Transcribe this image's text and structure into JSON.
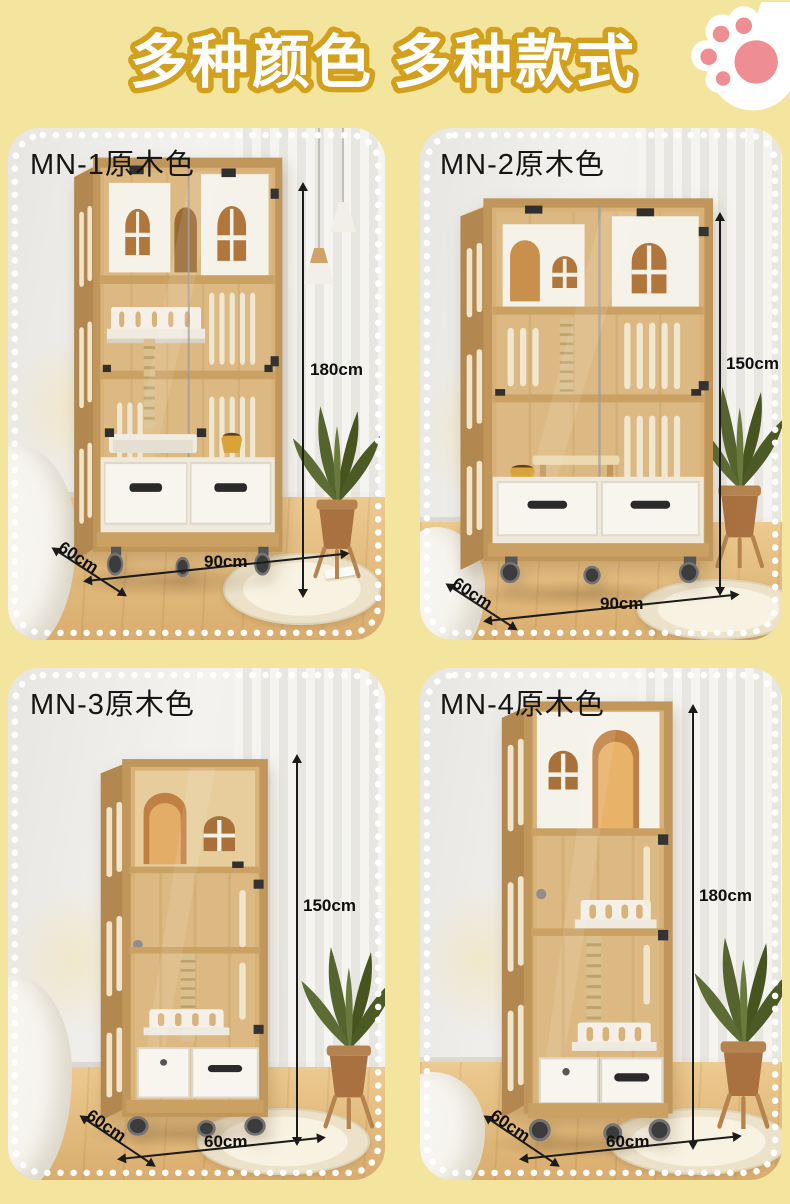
{
  "page": {
    "background_color": "#f3e59e"
  },
  "header": {
    "title": "多种颜色 多种款式",
    "title_fill": "#ffffff",
    "title_outline": "#d2a01d",
    "paw_icon_colors": {
      "base": "#ffffff",
      "pads": "#ee8e93"
    }
  },
  "panels": [
    {
      "label": "MN-1原木色",
      "height": "180cm",
      "depth": "60cm",
      "width": "90cm"
    },
    {
      "label": "MN-2原木色",
      "height": "150cm",
      "depth": "60cm",
      "width": "90cm"
    },
    {
      "label": "MN-3原木色",
      "height": "150cm",
      "depth": "60cm",
      "width": "60cm"
    },
    {
      "label": "MN-4原木色",
      "height": "180cm",
      "depth": "60cm",
      "width": "60cm"
    }
  ],
  "colors": {
    "wood": "#d8b279",
    "wood_frame": "#c1965a",
    "white_panel": "#f6f3ec",
    "floor": "#e2bc82"
  }
}
